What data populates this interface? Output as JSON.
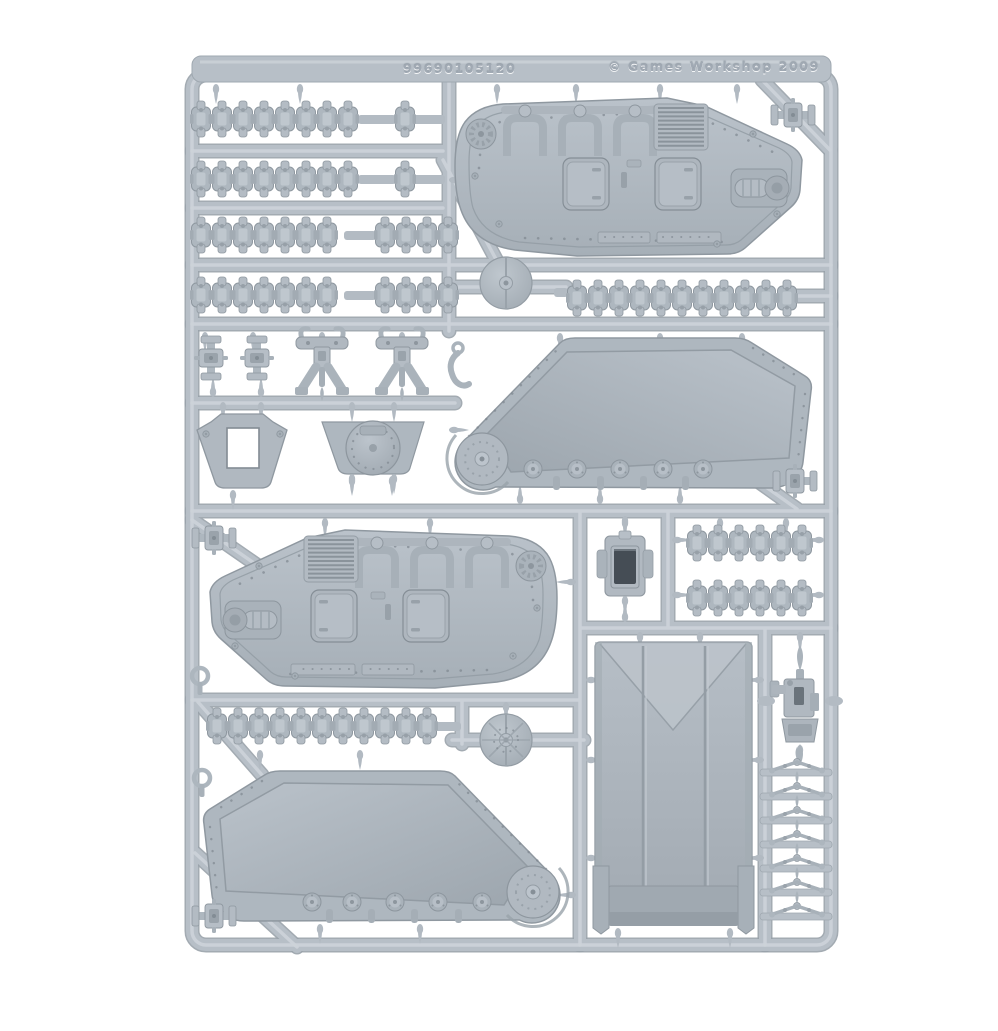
{
  "photo": {
    "subject": "grey plastic model sprue on a white background"
  },
  "embossed_text": {
    "part_code": "99690105120",
    "copyright": "© Games Workshop 2009"
  },
  "colors": {
    "background": "#ffffff",
    "sprue_rail": "#b7bfc7",
    "sprue_edge": "#99a2aa",
    "rail_highlight": "#cdd3d9",
    "part_base": "#aeb7bf",
    "part_highlight": "#c6cdd4",
    "part_shadow": "#8d969e",
    "deep_recess": "#454d55"
  },
  "parts": {
    "track_strips": [
      "8-link strip x2",
      "7-link strip x2",
      "4-link strip x2",
      "11-link strip x2",
      "6-link strip x2",
      "single link x2"
    ],
    "hull_panels": [
      "top-right hull panel with doors, louvres and exhaust",
      "middle-left hull panel (mirrored)"
    ],
    "track_guards": [
      "right track-guard with drive sprocket and road wheels",
      "bottom-left track-guard (mirrored)"
    ],
    "large_parts": [
      "assault ramp door"
    ],
    "small_parts": [
      "round hub disc x2",
      "domed hatch plate",
      "hitch plate with opening",
      "vision block",
      "lamp bracket x2",
      "pipe clamp x6",
      "eyelet ring x2",
      "stowage hook",
      "searchlight assembly",
      "grab handle x7"
    ]
  }
}
